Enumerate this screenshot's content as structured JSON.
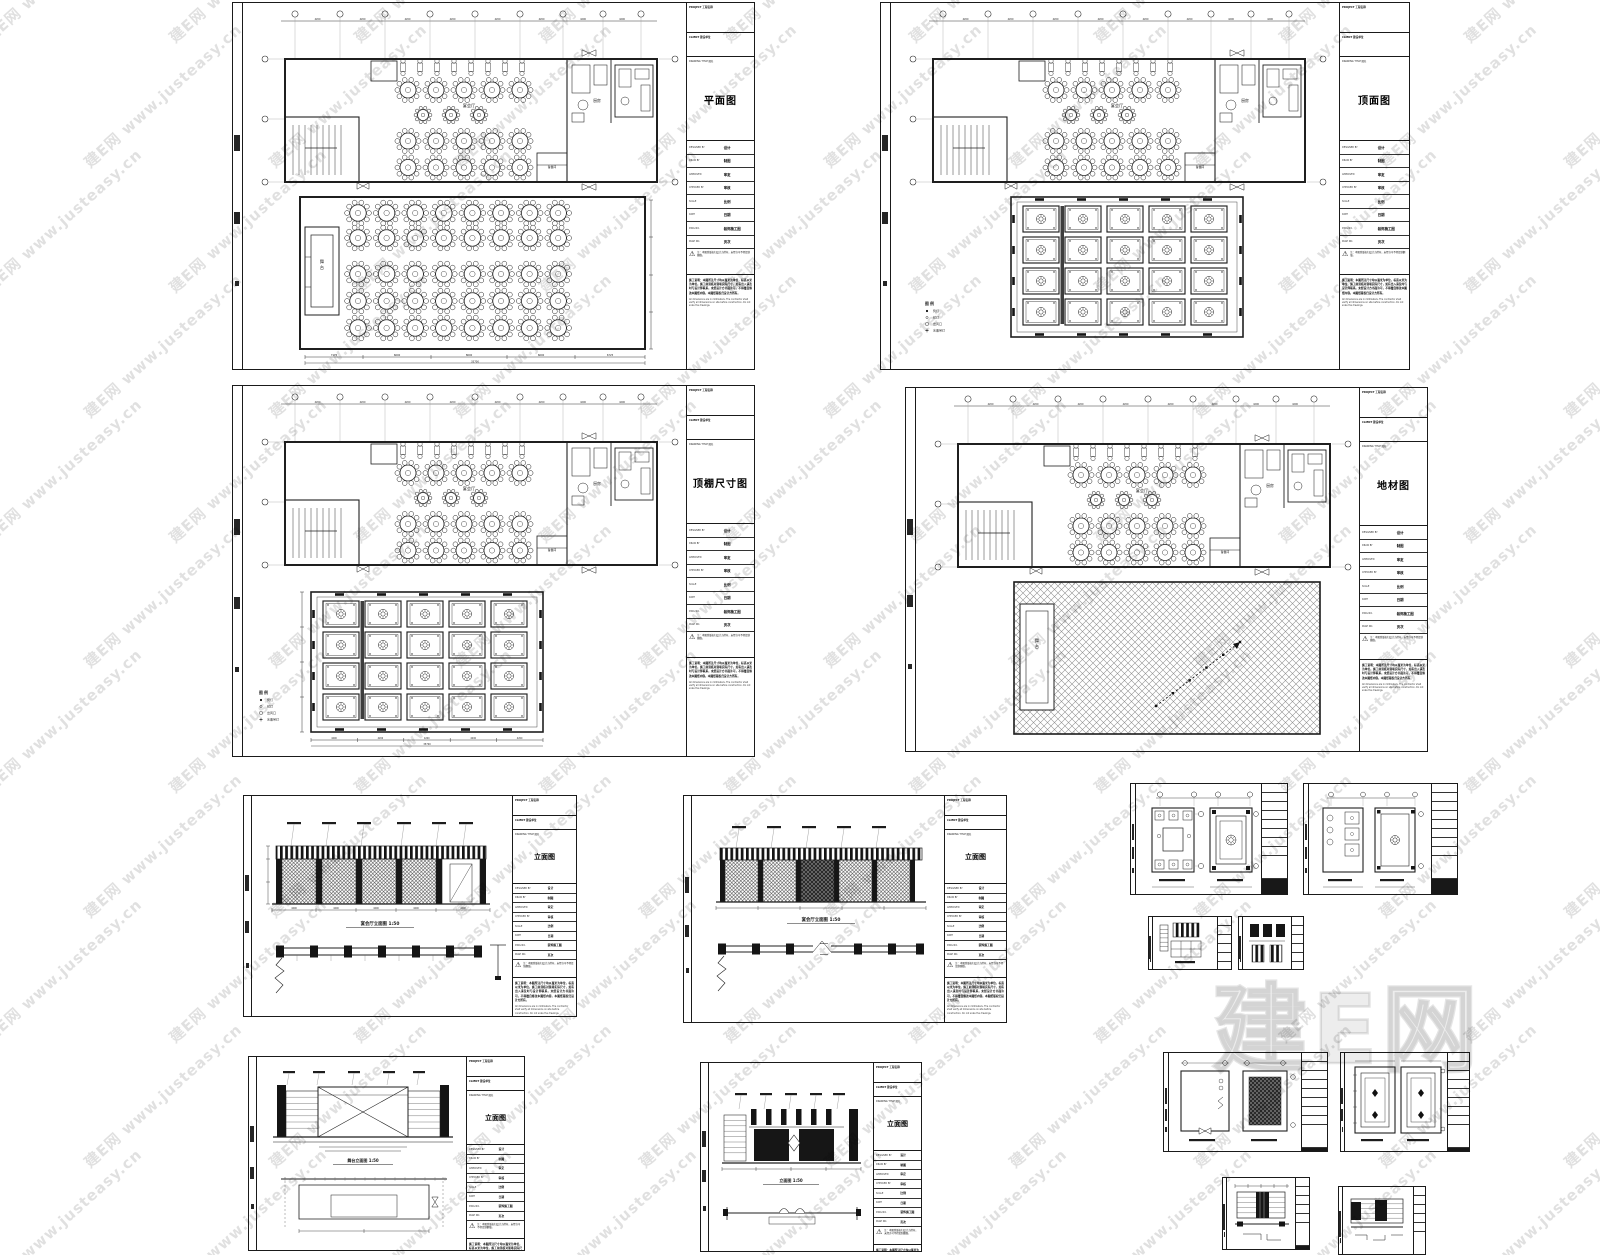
{
  "watermark": {
    "tile_text": "建E网 www.justeasy.cn",
    "big_text": "建E网",
    "color": "#d9d9d9"
  },
  "titleblock": {
    "project_label": "PROJECT 工程名称",
    "client_label": "CLIENT 建设单位",
    "title_label": "DRAWING TITLE 图名",
    "fields": [
      {
        "label": "DESIGNED BY",
        "value": "设计"
      },
      {
        "label": "DRAW BY",
        "value": "制图"
      },
      {
        "label": "APPROVED",
        "value": "审定"
      },
      {
        "label": "CHECKED BY",
        "value": "审核"
      },
      {
        "label": "SCALE",
        "value": "比例"
      },
      {
        "label": "DATE",
        "value": "日期"
      },
      {
        "label": "DWG NO.",
        "value": "装饰施工图"
      },
      {
        "label": "PAGE NO.",
        "value": "页次"
      }
    ],
    "warning": "注：本图纸版权归设计方所有，未经许可不得复制翻版。",
    "notes": "施工说明：本图所注尺寸均以毫米为单位，标高以米为单位。施工前须核对现场实际尺寸，如有出入请及时与设计师联系。未经设计方书面许可，不得擅自修改本图纸内容。本图纸版权归设计方所有。",
    "notes_en": "All dimensions are in millimeters. The contractor shall verify all dimensions on site before construction. Do not scale the drawings."
  },
  "sheets": {
    "plan": {
      "title": "平面图"
    },
    "ceiling": {
      "title": "顶面图"
    },
    "ceiling_dim": {
      "title": "顶棚尺寸图"
    },
    "floor": {
      "title": "地材图"
    },
    "elev_a": {
      "title": "立面图",
      "caption": "宴会厅立面图 1:50"
    },
    "elev_b": {
      "title": "立面图",
      "caption": "宴会厅立面图 1:50"
    },
    "elev_stage": {
      "title": "立面图",
      "caption": "舞台立面图 1:50"
    },
    "elev_c": {
      "title": "立面图",
      "caption": "立面图 1:50"
    }
  },
  "plan_labels": {
    "hall": "宴会厅",
    "kitchen": "厨房",
    "stage": "舞台",
    "prep": "备餐间"
  },
  "legend": {
    "header": "图 例",
    "items": [
      "筒灯",
      "射灯",
      "出风口",
      "水晶吊灯"
    ]
  },
  "dims": {
    "top": [
      "4200",
      "4200",
      "4200",
      "4200",
      "4200",
      "4200",
      "4200",
      "4200"
    ],
    "bottom": [
      "7175",
      "6600",
      "8600",
      "6600",
      "6725"
    ],
    "bottom_total": "35700"
  }
}
